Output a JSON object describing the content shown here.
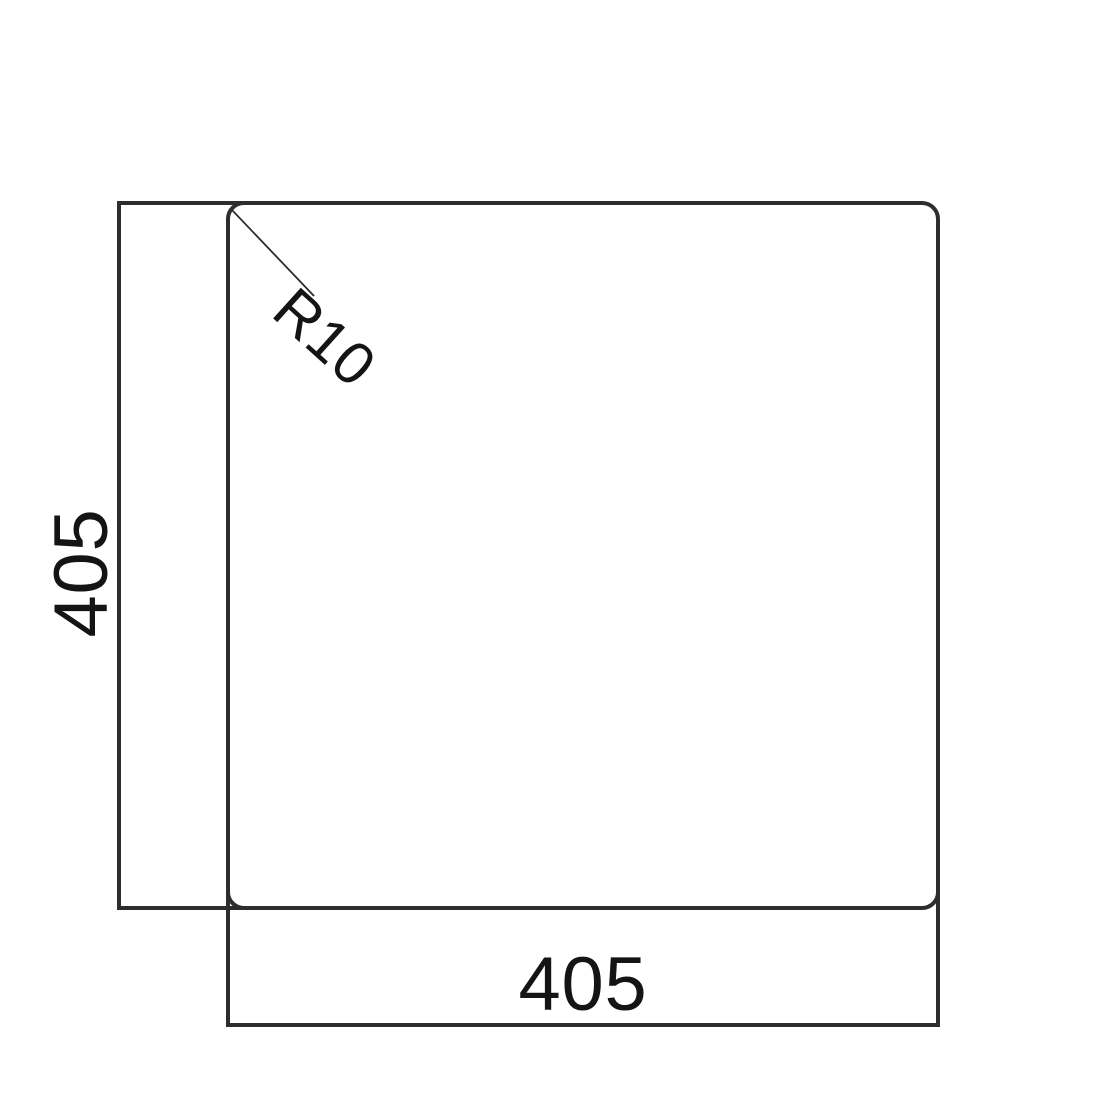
{
  "diagram": {
    "type": "technical-drawing",
    "subject": "square panel with rounded corners and dimensions",
    "labels": {
      "height": "405",
      "width": "405",
      "radius": "R10"
    },
    "colors": {
      "line": "#2d2d2d",
      "text": "#141414",
      "background": "#ffffff"
    }
  }
}
